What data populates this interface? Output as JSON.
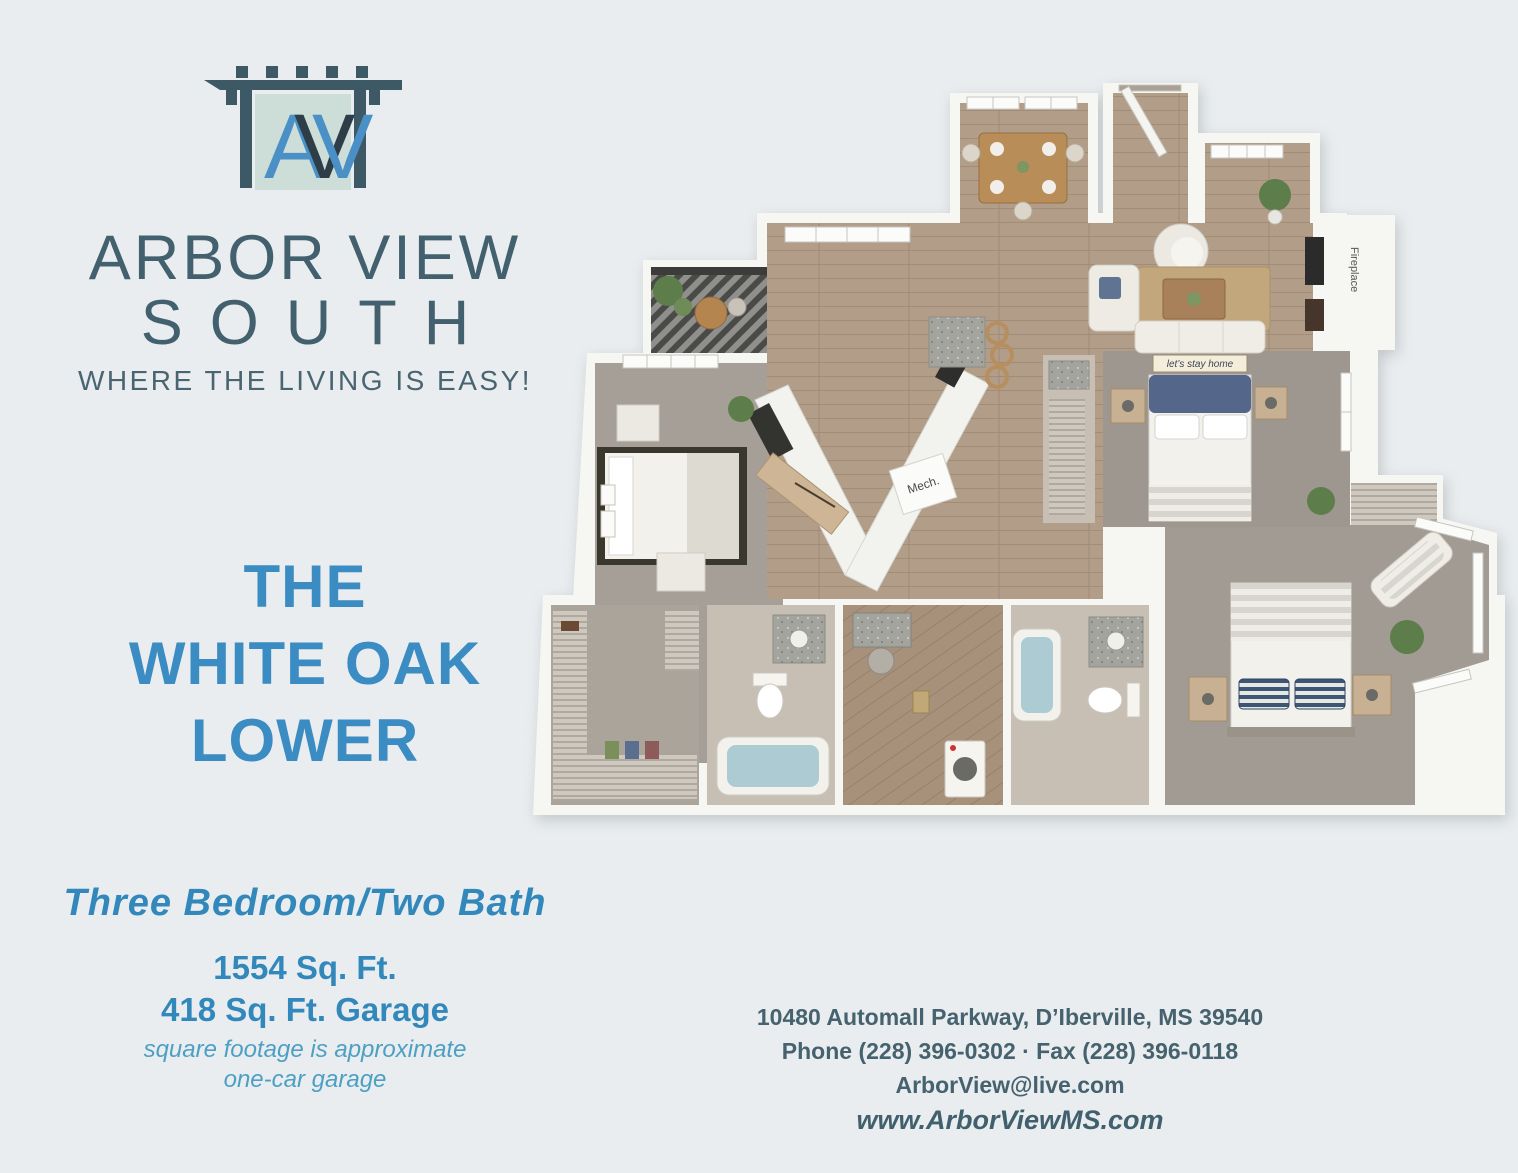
{
  "brand": {
    "monogram_a": "A",
    "monogram_v": "V",
    "name_line1": "ARBOR VIEW",
    "name_line2": "SOUTH",
    "tagline": "WHERE THE LIVING IS EASY!"
  },
  "plan_title": {
    "line1": "THE",
    "line2": "WHITE OAK",
    "line3": "LOWER"
  },
  "specs": {
    "bed_bath": "Three Bedroom/Two Bath",
    "area": "1554 Sq. Ft.",
    "garage": "418 Sq. Ft. Garage",
    "note1": "square footage is approximate",
    "note2": "one-car garage"
  },
  "contact": {
    "address": "10480 Automall Parkway, D’Iberville, MS 39540",
    "phone_fax": "Phone (228) 396-0302 · Fax (228) 396-0118",
    "email": "ArborView@live.com",
    "website": "www.ArborViewMS.com"
  },
  "floorplan_labels": {
    "mech": "Mech.",
    "fireplace": "Fireplace",
    "sign": "let’s stay home"
  },
  "colors": {
    "background": "#e9edef",
    "slate": "#42606e",
    "heading_blue": "#3a8cc3",
    "note_blue": "#4d9fc4",
    "logo_panel": "#cdddd8",
    "logo_blue": "#4a90c6",
    "wood_floor": "#b29d88",
    "carpet": "#a69f97",
    "tub_water": "#accbd3"
  }
}
